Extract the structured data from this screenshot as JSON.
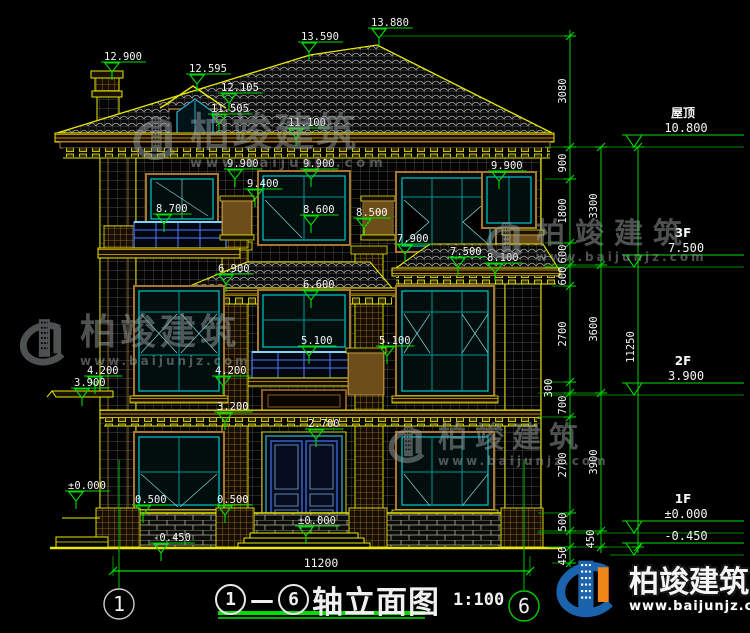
{
  "drawing": {
    "background": "#000000",
    "colors": {
      "line_yellow": "#e8e800",
      "line_green": "#00e400",
      "line_cyan": "#00c8c8",
      "trim_tan": "#a8762c",
      "rail_blue": "#4d79ff",
      "text_white": "#f5f5f5"
    },
    "title": {
      "axis_start": "1",
      "separator": "—",
      "axis_end": "6",
      "name": "轴立面图",
      "scale": "1:100"
    },
    "watermark": {
      "name": "柏竣建筑",
      "url": "www.baijunjz.com"
    },
    "brand": {
      "name": "柏竣建筑",
      "url": "www.baijunjz.com"
    },
    "axis_bubbles": [
      {
        "num": "1",
        "cx": 119,
        "cy": 604,
        "color": "#cccccc"
      },
      {
        "num": "6",
        "cx": 524,
        "cy": 606,
        "color": "#00cc00"
      }
    ],
    "spot_elevations": [
      {
        "text": "12.900",
        "x": 104,
        "y": 60
      },
      {
        "text": "13.590",
        "x": 301,
        "y": 40
      },
      {
        "text": "13.880",
        "x": 371,
        "y": 26
      },
      {
        "text": "12.595",
        "x": 189,
        "y": 72
      },
      {
        "text": "12.105",
        "x": 221,
        "y": 91
      },
      {
        "text": "11.505",
        "x": 211,
        "y": 112
      },
      {
        "text": "11.100",
        "x": 288,
        "y": 126
      },
      {
        "text": "9.900",
        "x": 227,
        "y": 167
      },
      {
        "text": "9.900",
        "x": 303,
        "y": 167
      },
      {
        "text": "9.900",
        "x": 491,
        "y": 169
      },
      {
        "text": "9.400",
        "x": 247,
        "y": 187
      },
      {
        "text": "8.700",
        "x": 156,
        "y": 212
      },
      {
        "text": "8.600",
        "x": 303,
        "y": 213
      },
      {
        "text": "8.500",
        "x": 356,
        "y": 216
      },
      {
        "text": "8.100",
        "x": 487,
        "y": 261
      },
      {
        "text": "7.900",
        "x": 397,
        "y": 242
      },
      {
        "text": "7.500",
        "x": 450,
        "y": 255
      },
      {
        "text": "6.900",
        "x": 218,
        "y": 272
      },
      {
        "text": "6.600",
        "x": 303,
        "y": 288
      },
      {
        "text": "5.100",
        "x": 301,
        "y": 344
      },
      {
        "text": "5.100",
        "x": 379,
        "y": 344
      },
      {
        "text": "4.200",
        "x": 87,
        "y": 374
      },
      {
        "text": "4.200",
        "x": 215,
        "y": 374
      },
      {
        "text": "3.900",
        "x": 74,
        "y": 386
      },
      {
        "text": "3.200",
        "x": 217,
        "y": 410
      },
      {
        "text": "2.700",
        "x": 308,
        "y": 427
      },
      {
        "text": "0.500",
        "x": 135,
        "y": 503
      },
      {
        "text": "0.500",
        "x": 217,
        "y": 503
      },
      {
        "text": "±0.000",
        "x": 68,
        "y": 489
      },
      {
        "text": "±0.000",
        "x": 298,
        "y": 524
      },
      {
        "text": "-0.450",
        "x": 153,
        "y": 541
      }
    ],
    "level_flags": [
      {
        "floor": "屋顶",
        "value": "10.800",
        "y": 147
      },
      {
        "floor": "3F",
        "value": "7.500",
        "y": 267
      },
      {
        "floor": "2F",
        "value": "3.900",
        "y": 395
      },
      {
        "floor": "1F",
        "value": "±0.000",
        "y": 533
      },
      {
        "floor": "",
        "value": "-0.450",
        "y": 555
      }
    ],
    "dim_chains": [
      {
        "x": 570,
        "y1": 30,
        "y2": 567,
        "ticks": [
          36,
          147,
          179,
          243,
          265,
          286,
          382,
          393,
          417,
          513,
          531,
          547,
          563
        ]
      },
      {
        "x": 601,
        "y1": 147,
        "y2": 553,
        "ticks": [
          147,
          265,
          393,
          531,
          547
        ]
      },
      {
        "x": 638,
        "y1": 147,
        "y2": 553,
        "ticks": [
          147,
          547
        ]
      }
    ],
    "dim_rotated": [
      {
        "text": "3080",
        "x": 566,
        "y": 91
      },
      {
        "text": "900",
        "x": 566,
        "y": 163
      },
      {
        "text": "1800",
        "x": 566,
        "y": 211
      },
      {
        "text": "600",
        "x": 566,
        "y": 254
      },
      {
        "text": "600",
        "x": 566,
        "y": 276
      },
      {
        "text": "2700",
        "x": 566,
        "y": 334
      },
      {
        "text": "300",
        "x": 552,
        "y": 388
      },
      {
        "text": "700",
        "x": 566,
        "y": 405
      },
      {
        "text": "2700",
        "x": 566,
        "y": 465
      },
      {
        "text": "500",
        "x": 566,
        "y": 522
      },
      {
        "text": "450",
        "x": 566,
        "y": 556
      },
      {
        "text": "3300",
        "x": 597,
        "y": 206
      },
      {
        "text": "3600",
        "x": 597,
        "y": 329
      },
      {
        "text": "3900",
        "x": 597,
        "y": 462
      },
      {
        "text": "450",
        "x": 594,
        "y": 539
      },
      {
        "text": "11250",
        "x": 634,
        "y": 347
      }
    ],
    "dim_horizontal": [
      {
        "text": "11200",
        "x": 321,
        "y": 567
      }
    ]
  }
}
